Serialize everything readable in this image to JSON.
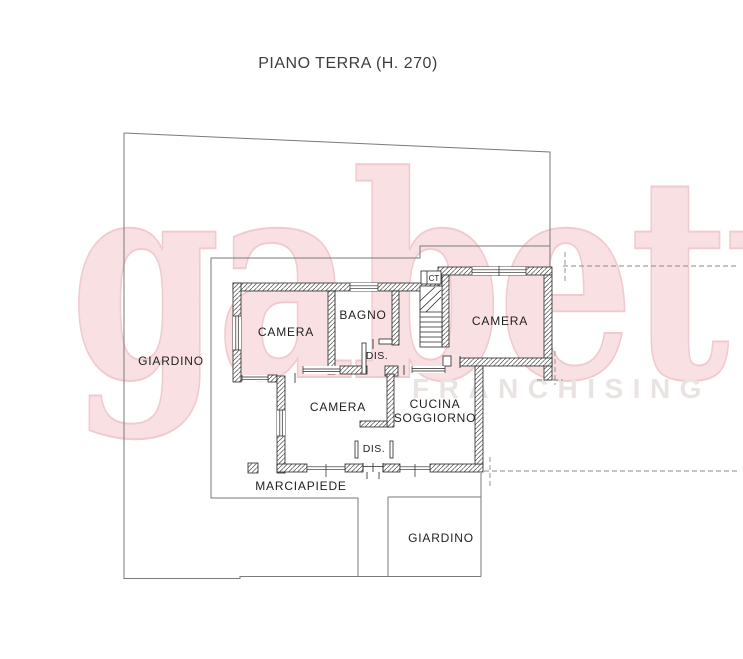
{
  "title": "PIANO TERRA (H. 270)",
  "watermark": {
    "brand": "gabetti",
    "subbrand": "FRANCHISING",
    "brand_fill": "#f8e0e3",
    "brand_outline": "#f1cad0",
    "subbrand_color": "#e9e4e2"
  },
  "rooms": {
    "camera_nw": "CAMERA",
    "bagno": "BAGNO",
    "dis_upper": "DIS.",
    "camera_ne": "CAMERA",
    "camera_south": "CAMERA",
    "cucina_line1": "CUCINA",
    "cucina_line2": "SOGGIORNO",
    "dis_lower": "DIS.",
    "boiler": "CT"
  },
  "outdoor": {
    "giardino_west": "GIARDINO",
    "giardino_south": "GIARDINO",
    "marciapiede": "MARCIAPIEDE"
  },
  "colors": {
    "wall_line": "#262626",
    "boundary_line": "#7a7a7a",
    "dashed_line": "#8a8a8a",
    "hatch_line": "#4a4a4a"
  }
}
